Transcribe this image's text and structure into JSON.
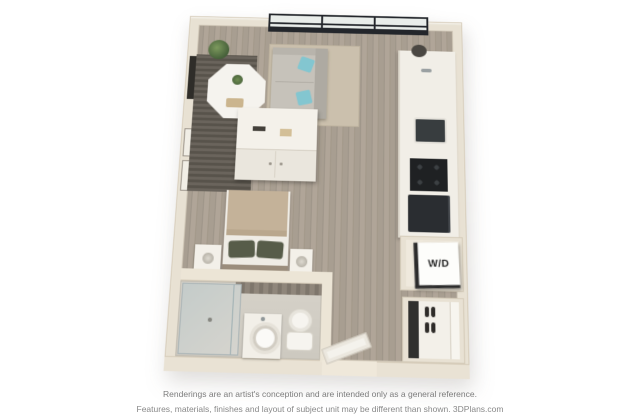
{
  "title": "3D studio apartment floor plan rendering",
  "floorplan": {
    "view": "isometric-top-down",
    "rooms": [
      "living-dining",
      "kitchen",
      "sleeping-area",
      "bathroom",
      "entry",
      "closet",
      "laundry"
    ],
    "labels": {
      "washer_dryer": "W/D"
    },
    "furniture": [
      "wall-tv",
      "potted-plant",
      "octagonal-dining-table",
      "sofa-with-teal-pillows",
      "area-rug",
      "white-console-cabinet",
      "bed-with-tan-blanket",
      "two-nightstands",
      "kitchen-sink",
      "cooktop",
      "refrigerator",
      "glass-shower",
      "vanity-vessel-sink",
      "toilet",
      "open-entry-door",
      "shoe-closet",
      "stacked-washer-dryer"
    ],
    "colors": {
      "wall": "#e8e1d3",
      "floor_wood": "#a89e91",
      "accent_rug_dark": "#5f5a52",
      "rug_beige": "#cbc0ad",
      "sofa": "#c6c2ba",
      "pillow_teal": "#83c6d0",
      "bed_blanket": "#c4b299",
      "appliance_dark": "#25282c",
      "window_frame": "#23262b",
      "background": "#ffffff",
      "footer_text": "#7c7c7c"
    }
  },
  "footer": {
    "line1": "Renderings are an artist's conception and are intended only as a general reference.",
    "line2": "Features, materials, finishes and layout of subject unit may be different than shown. 3DPlans.com"
  }
}
